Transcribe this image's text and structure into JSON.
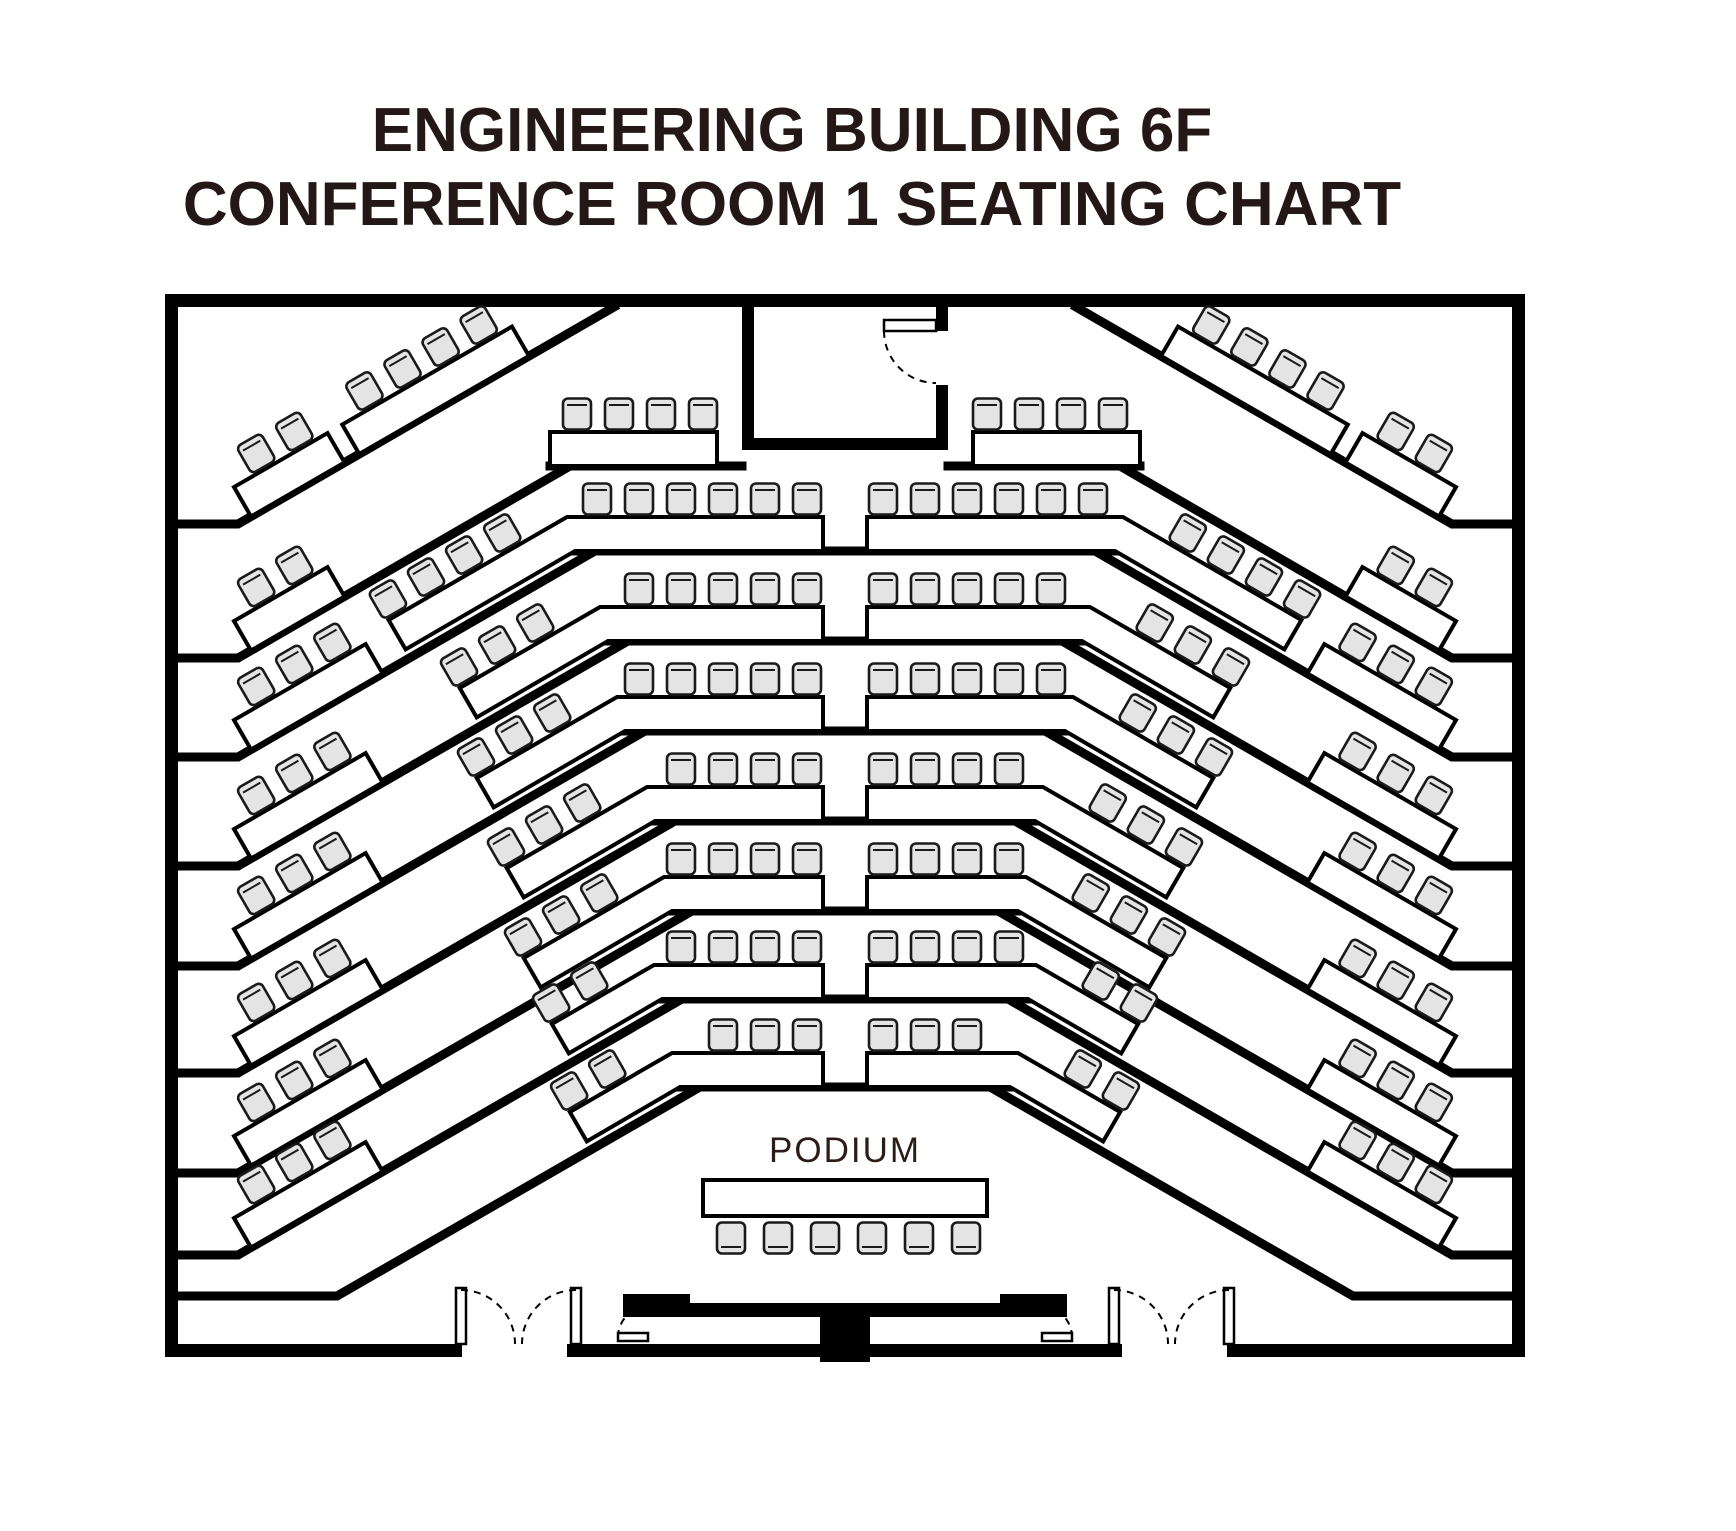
{
  "title": {
    "line1": "ENGINEERING BUILDING 6F",
    "line2": "CONFERENCE ROOM 1 SEATING CHART"
  },
  "podium": {
    "label": "PODIUM",
    "seats": 6
  },
  "colors": {
    "background": "#ffffff",
    "wall": "#000000",
    "line": "#000000",
    "chair_fill": "#e4e4e4",
    "chair_stroke": "#1a1a1a",
    "title_text": "#231815",
    "podium_text": "#2b1d16"
  },
  "seating_summary": {
    "tiered_rows": 8,
    "per_side_by_row": [
      {
        "row": 1,
        "outer": 2,
        "inner": 4,
        "center": 4
      },
      {
        "row": 2,
        "outer": 2,
        "inner": 4,
        "center": 6
      },
      {
        "row": 3,
        "outer": 3,
        "inner": 3,
        "center": 5
      },
      {
        "row": 4,
        "outer": 3,
        "inner": 3,
        "center": 5
      },
      {
        "row": 5,
        "outer": 3,
        "inner": 3,
        "center": 4
      },
      {
        "row": 6,
        "outer": 3,
        "inner": 3,
        "center": 4
      },
      {
        "row": 7,
        "outer": 3,
        "inner": 2,
        "center": 4
      },
      {
        "row": 8,
        "outer": 3,
        "inner": 2,
        "center": 3
      }
    ],
    "podium_seats": 6,
    "total_seats": 168
  },
  "layout": {
    "mirrorX": 1690,
    "walls": [
      [
        165,
        294,
        1360,
        13
      ],
      [
        165,
        294,
        13,
        1063
      ],
      [
        1512,
        294,
        13,
        1063
      ],
      [
        165,
        1344,
        297,
        13
      ],
      [
        567,
        1344,
        555,
        13
      ],
      [
        1227,
        1344,
        298,
        13
      ]
    ],
    "alcove": {
      "rects": [
        [
          742,
          307,
          12,
          143
        ],
        [
          936,
          307,
          12,
          24
        ],
        [
          936,
          385,
          12,
          65
        ],
        [
          742,
          438,
          206,
          12
        ]
      ],
      "leaf": [
        884,
        320,
        52,
        11
      ],
      "arc": "M884 331 A52 52 0 0 0 936 383"
    },
    "tierRow1": [
      [
        550,
        466,
        742
      ],
      [
        948,
        466,
        1140
      ]
    ],
    "tierRows": [
      [
        575,
        551
      ],
      [
        608,
        641
      ],
      [
        625,
        731
      ],
      [
        655,
        821
      ],
      [
        672,
        911
      ],
      [
        662,
        999
      ],
      [
        680,
        1087
      ]
    ],
    "diagonals": [
      {
        "stub": 524,
        "stubEnd": 238,
        "jx": 614,
        "jy": 307
      },
      {
        "stub": 658,
        "stubEnd": 238,
        "jx": 570,
        "jy": 466
      },
      {
        "stub": 757,
        "stubEnd": 238,
        "jx": 595,
        "jy": 551
      },
      {
        "stub": 866,
        "stubEnd": 238,
        "jx": 628,
        "jy": 641
      },
      {
        "stub": 966,
        "stubEnd": 238,
        "jx": 645,
        "jy": 731
      },
      {
        "stub": 1073,
        "stubEnd": 238,
        "jx": 675,
        "jy": 821
      },
      {
        "stub": 1173,
        "stubEnd": 238,
        "jx": 692,
        "jy": 911
      },
      {
        "stub": 1255,
        "stubEnd": 238,
        "jx": 682,
        "jy": 999
      },
      {
        "stub": 1296,
        "stubEnd": 337,
        "jx": 700,
        "jy": 1087
      }
    ],
    "outerTables": [
      {
        "d": 0,
        "off": 15,
        "seats": 2
      },
      {
        "d": 1,
        "off": 15,
        "seats": 2
      },
      {
        "d": 2,
        "off": 15,
        "seats": 3
      },
      {
        "d": 3,
        "off": 15,
        "seats": 3
      },
      {
        "d": 4,
        "off": 15,
        "seats": 3
      },
      {
        "d": 5,
        "off": 15,
        "seats": 3
      },
      {
        "d": 6,
        "off": 15,
        "seats": 3
      },
      {
        "d": 7,
        "off": 15,
        "seats": 3
      }
    ],
    "innerTable1": {
      "d": 0,
      "off": 140,
      "seats": 4
    },
    "row1Center": {
      "x": 550,
      "y": 432,
      "w": 167,
      "h": 34,
      "seats": 4,
      "firstSeatX": 577,
      "seatY": 414
    },
    "counters": [
      {
        "y": 551,
        "bend": 575,
        "seats": 6,
        "dseats": 4
      },
      {
        "y": 641,
        "bend": 608,
        "seats": 5,
        "dseats": 3
      },
      {
        "y": 731,
        "bend": 625,
        "seats": 5,
        "dseats": 3
      },
      {
        "y": 821,
        "bend": 655,
        "seats": 4,
        "dseats": 3
      },
      {
        "y": 911,
        "bend": 672,
        "seats": 4,
        "dseats": 3
      },
      {
        "y": 999,
        "bend": 662,
        "seats": 4,
        "dseats": 2
      },
      {
        "y": 1087,
        "bend": 680,
        "seats": 3,
        "dseats": 2
      }
    ],
    "aisleRight": 823,
    "centerSeatStartX": 807,
    "centerSeatPitch": 42,
    "chair": {
      "w": 28,
      "h": 31,
      "rx": 5
    },
    "podium": {
      "table": [
        703,
        1180,
        284,
        36
      ],
      "seatY": 1238,
      "seatStart": 731,
      "seatPitch": 47,
      "labelX": 845,
      "labelY": 1162
    },
    "platform": {
      "path": "M623 1294 H690 V1303 H1000 V1294 H1067 V1317 H623 Z",
      "lectern": [
        820,
        1316,
        50,
        46
      ],
      "doors": [
        {
          "leaf": [
            618,
            1333,
            30,
            8
          ],
          "arc": "M618 1337 A30 30 0 0 1 648 1307"
        },
        {
          "leaf": [
            1042,
            1333,
            30,
            8
          ],
          "arc": "M1072 1337 A30 30 0 0 0 1042 1307"
        }
      ]
    },
    "bottomDoors": {
      "leaves": [
        [
          456,
          1288,
          10,
          56
        ],
        [
          571,
          1288,
          10,
          56
        ],
        [
          1109,
          1288,
          10,
          56
        ],
        [
          1224,
          1288,
          10,
          56
        ]
      ],
      "arcs": [
        "M461 1290 A54 54 0 0 1 515 1344",
        "M576 1290 A54 54 0 0 0 522 1344",
        "M1114 1290 A54 54 0 0 1 1168 1344",
        "M1229 1290 A54 54 0 0 0 1175 1344"
      ]
    }
  }
}
